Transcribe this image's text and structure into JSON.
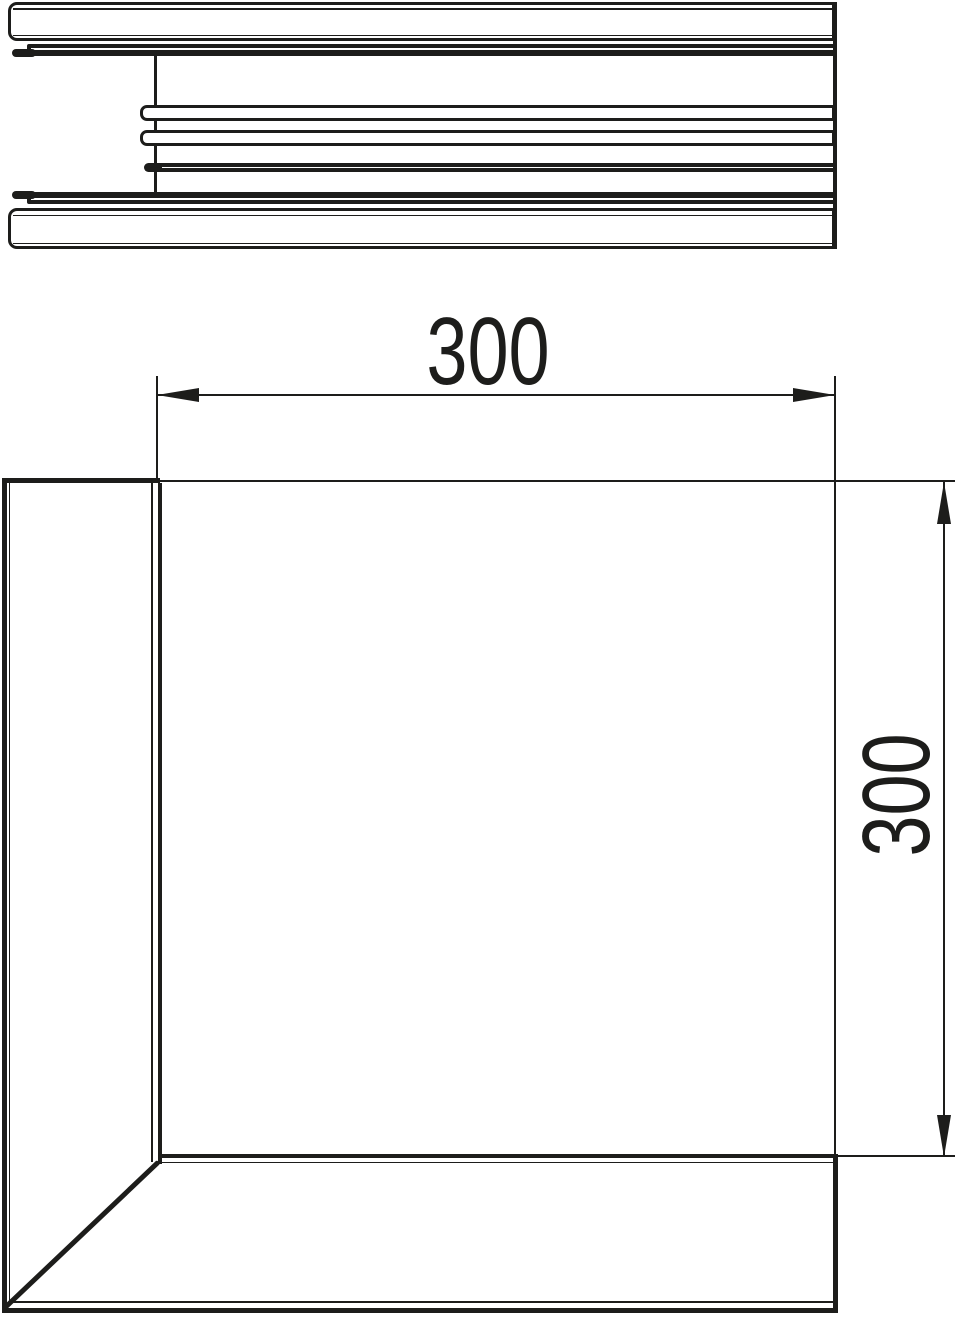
{
  "drawing": {
    "ink_color": "#1d1d1b",
    "background_color": "#ffffff",
    "dimensions": {
      "width": {
        "value": "300"
      },
      "height": {
        "value": "300"
      }
    }
  }
}
